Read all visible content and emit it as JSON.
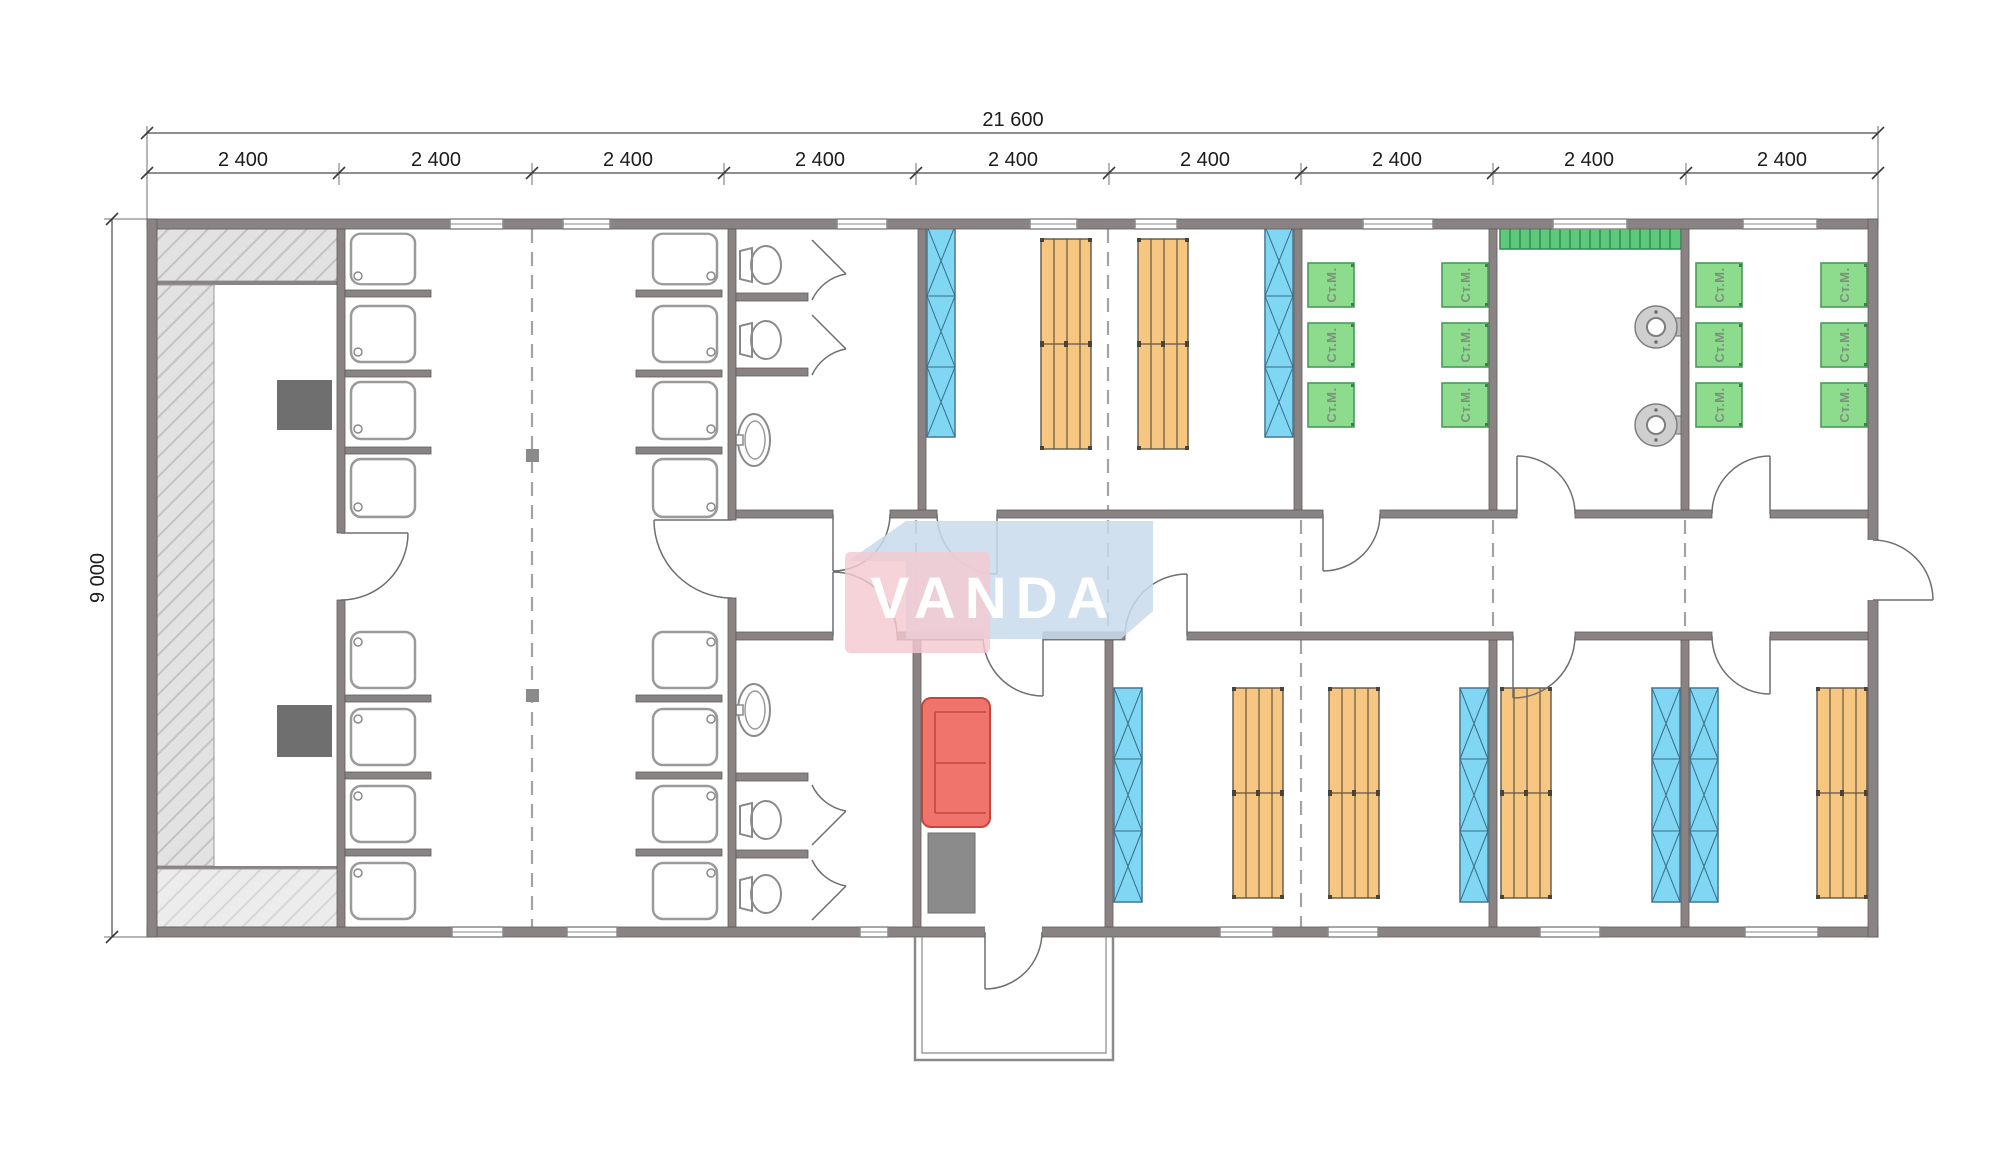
{
  "drawing": {
    "type": "floor-plan",
    "dimensions": {
      "total_width_label": "21 600",
      "height_label": "9 000",
      "segment_labels": [
        "2 400",
        "2 400",
        "2 400",
        "2 400",
        "2 400",
        "2 400",
        "2 400",
        "2 400",
        "2 400"
      ]
    },
    "watermark": {
      "text": "VANDA"
    },
    "equipment_labels": {
      "washing_machine": "Ст.М."
    },
    "colors": {
      "wall": "#8a8383",
      "wardrobe_blue": "#7fd7f3",
      "bed_orange": "#f7c680",
      "machine_green": "#8ddc8d",
      "rack_green": "#5ec87b",
      "sofa_red": "#f1746c",
      "table_gray": "#6f6f6f",
      "watermark_pink": "#f4c9d1",
      "watermark_blue": "#c9daeb"
    },
    "inventory": {
      "shower_trays": 16,
      "toilets": 4,
      "washbasins": 2,
      "wardrobes": 6,
      "bunk_bed_groups": 6,
      "washing_machines": 12,
      "water_heaters": 2,
      "drying_racks": 1,
      "sofas": 1,
      "tables": 3,
      "entrance_porches": 1
    }
  }
}
